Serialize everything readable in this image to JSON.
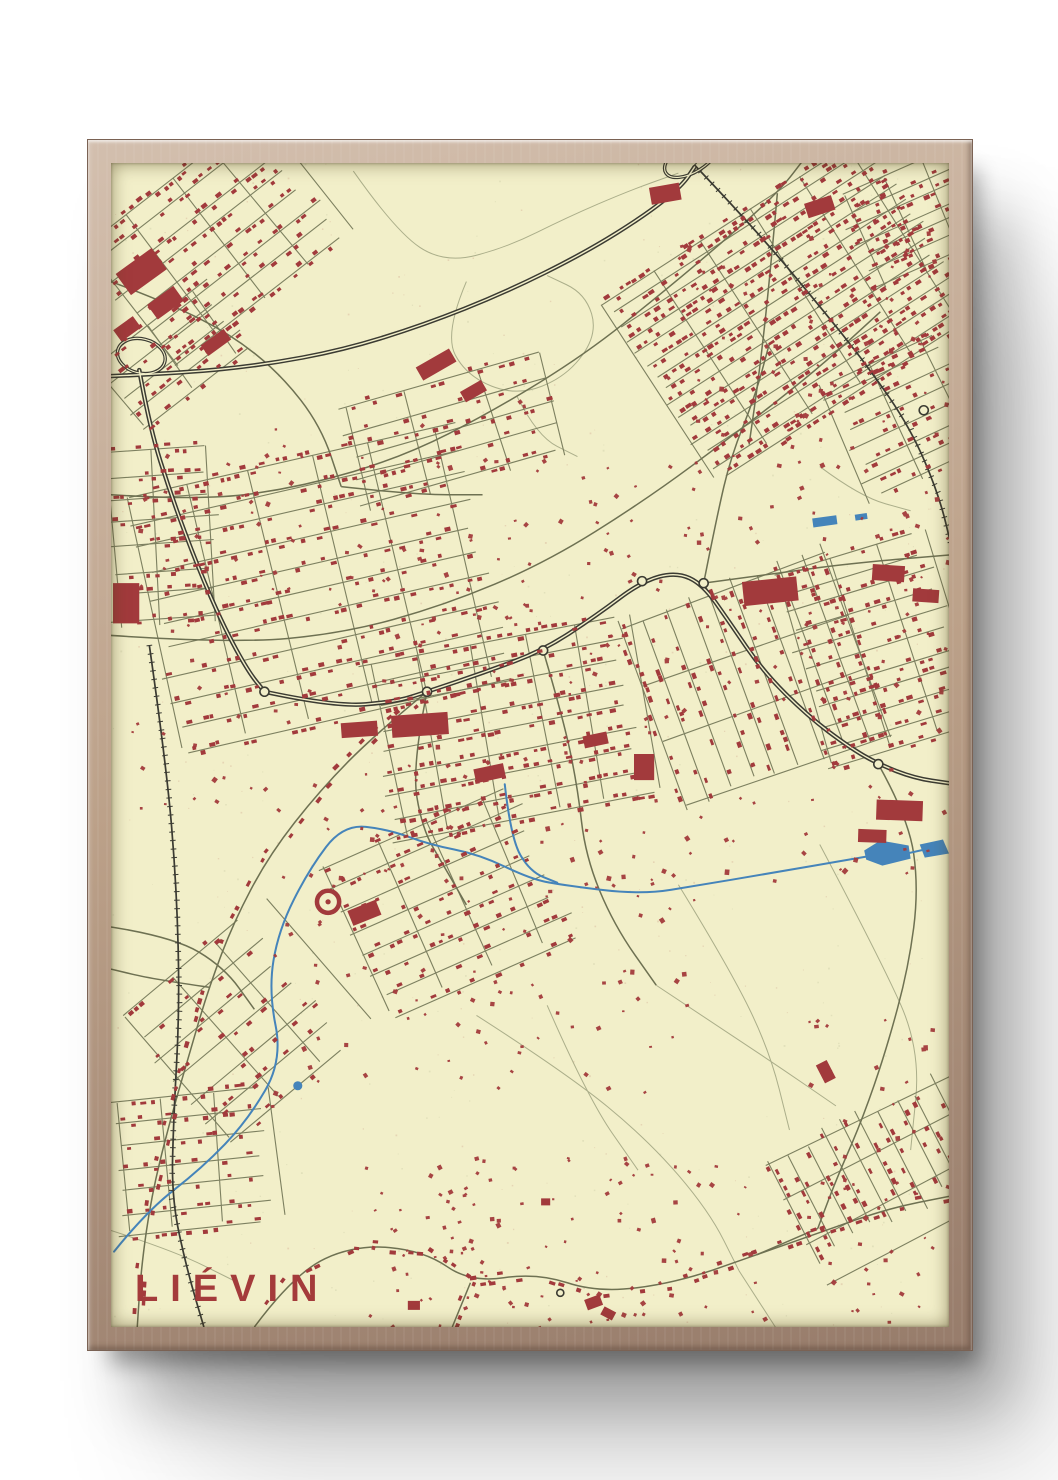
{
  "poster": {
    "title": "LIÉVIN"
  },
  "style": {
    "paper": "#f2efc9",
    "building": "#a23a3c",
    "street": "#7d8060",
    "road": "#6e7152",
    "faint": "#abae8a",
    "dark": "#3b3b32",
    "water": "#4584ba",
    "title": "#a43b3b",
    "wood_light": "#d3bfae",
    "wood_mid": "#bca189",
    "wood_dark": "#977c6b",
    "frame_edge": "#7a6254",
    "backdrop": "#ffffff"
  },
  "map": {
    "seed": 11,
    "view": [
      830,
      1158
    ],
    "speckles": 260,
    "faint": [
      [
        [
          240,
          8
        ],
        [
          282,
          68
        ],
        [
          330,
          100
        ],
        [
          392,
          84
        ],
        [
          452,
          54
        ],
        [
          512,
          28
        ],
        [
          562,
          10
        ]
      ],
      [
        [
          352,
          118
        ],
        [
          330,
          170
        ],
        [
          352,
          212
        ],
        [
          402,
          232
        ],
        [
          452,
          212
        ],
        [
          482,
          170
        ],
        [
          470,
          130
        ],
        [
          432,
          112
        ]
      ],
      [
        [
          402,
          232
        ],
        [
          422,
          272
        ],
        [
          462,
          292
        ]
      ],
      [
        [
          362,
          848
        ],
        [
          452,
          906
        ],
        [
          532,
          972
        ],
        [
          592,
          1042
        ],
        [
          622,
          1102
        ]
      ],
      [
        [
          562,
          718
        ],
        [
          612,
          800
        ],
        [
          652,
          882
        ],
        [
          672,
          962
        ]
      ],
      [
        [
          702,
          678
        ],
        [
          762,
          792
        ],
        [
          802,
          882
        ],
        [
          792,
          982
        ]
      ],
      [
        [
          432,
          838
        ],
        [
          472,
          930
        ],
        [
          522,
          1002
        ]
      ],
      [
        [
          0,
          1062
        ],
        [
          62,
          1082
        ],
        [
          122,
          1112
        ]
      ],
      [
        [
          702,
          302
        ],
        [
          742,
          332
        ],
        [
          792,
          346
        ]
      ],
      [
        [
          540,
          818
        ],
        [
          600,
          858
        ],
        [
          660,
          898
        ],
        [
          718,
          938
        ]
      ],
      [
        [
          622,
          1102
        ],
        [
          658,
          1158
        ]
      ]
    ],
    "roads": [
      {
        "p": [
          [
            0,
            330
          ],
          [
            90,
            336
          ],
          [
            190,
            322
          ],
          [
            290,
            292
          ],
          [
            380,
            246
          ],
          [
            470,
            190
          ],
          [
            545,
            130
          ],
          [
            610,
            75
          ],
          [
            662,
            28
          ],
          [
            688,
            -6
          ]
        ]
      },
      {
        "p": [
          [
            0,
            470
          ],
          [
            120,
            478
          ],
          [
            230,
            468
          ],
          [
            330,
            440
          ],
          [
            430,
            398
          ],
          [
            530,
            335
          ],
          [
            620,
            268
          ],
          [
            700,
            205
          ],
          [
            762,
            148
          ]
        ]
      },
      {
        "p": [
          [
            313,
            526
          ],
          [
            298,
            600
          ],
          [
            308,
            662
          ],
          [
            330,
            700
          ],
          [
            352,
            738
          ]
        ]
      },
      {
        "p": [
          [
            428,
            485
          ],
          [
            448,
            553
          ],
          [
            462,
            620
          ],
          [
            470,
            690
          ],
          [
            498,
            758
          ],
          [
            540,
            818
          ]
        ]
      },
      {
        "p": [
          [
            587,
            418
          ],
          [
            600,
            352
          ],
          [
            614,
            292
          ],
          [
            638,
            232
          ],
          [
            652,
            180
          ]
        ]
      },
      {
        "p": [
          [
            587,
            418
          ],
          [
            660,
            408
          ],
          [
            735,
            398
          ],
          [
            830,
            390
          ]
        ]
      },
      {
        "p": [
          [
            660,
            30
          ],
          [
            652,
            120
          ],
          [
            642,
            210
          ],
          [
            632,
            280
          ]
        ]
      },
      {
        "p": [
          [
            313,
            526
          ],
          [
            262,
            568
          ],
          [
            207,
            624
          ],
          [
            157,
            688
          ],
          [
            122,
            754
          ],
          [
            97,
            820
          ],
          [
            77,
            888
          ],
          [
            57,
            958
          ],
          [
            40,
            1028
          ],
          [
            30,
            1098
          ],
          [
            26,
            1158
          ]
        ],
        "b": 0.5
      },
      {
        "p": [
          [
            142,
            1158
          ],
          [
            182,
            1104
          ],
          [
            242,
            1076
          ],
          [
            310,
            1082
          ],
          [
            356,
            1114
          ],
          [
            422,
            1104
          ],
          [
            482,
            1124
          ],
          [
            560,
            1114
          ],
          [
            640,
            1086
          ],
          [
            702,
            1064
          ],
          [
            770,
            1040
          ],
          [
            830,
            1028
          ]
        ],
        "b": 0.55
      },
      {
        "p": [
          [
            356,
            1114
          ],
          [
            338,
            1158
          ]
        ],
        "b": 0.5
      },
      {
        "p": [
          [
            760,
            598
          ],
          [
            790,
            652
          ],
          [
            800,
            722
          ],
          [
            790,
            800
          ],
          [
            768,
            882
          ],
          [
            744,
            952
          ],
          [
            718,
            1012
          ],
          [
            700,
            1060
          ]
        ]
      },
      {
        "p": [
          [
            0,
            760
          ],
          [
            62,
            770
          ],
          [
            112,
            800
          ],
          [
            142,
            842
          ]
        ]
      },
      {
        "p": [
          [
            97,
            820
          ],
          [
            42,
            812
          ],
          [
            0,
            802
          ]
        ]
      },
      {
        "p": [
          [
            0,
            118
          ],
          [
            58,
            140
          ],
          [
            118,
            170
          ],
          [
            168,
            210
          ],
          [
            208,
            262
          ],
          [
            228,
            322
          ]
        ]
      },
      {
        "p": [
          [
            228,
            322
          ],
          [
            300,
            330
          ],
          [
            368,
            330
          ]
        ]
      },
      {
        "p": [
          [
            700,
            1060
          ],
          [
            640,
            1086
          ]
        ]
      }
    ],
    "motorways": [
      [
        [
          0,
          212
        ],
        [
          70,
          209
        ],
        [
          150,
          201
        ],
        [
          230,
          186
        ],
        [
          310,
          161
        ],
        [
          390,
          129
        ],
        [
          470,
          89
        ],
        [
          532,
          50
        ],
        [
          566,
          22
        ],
        [
          578,
          4
        ]
      ],
      [
        [
          28,
          206
        ],
        [
          38,
          262
        ],
        [
          60,
          332
        ],
        [
          86,
          402
        ],
        [
          112,
          462
        ],
        [
          136,
          506
        ],
        [
          152,
          526
        ]
      ],
      [
        [
          152,
          526
        ],
        [
          222,
          541
        ],
        [
          282,
          536
        ],
        [
          313,
          526
        ],
        [
          372,
          506
        ],
        [
          428,
          485
        ],
        [
          481,
          450
        ],
        [
          526,
          416
        ],
        [
          560,
          407
        ],
        [
          586,
          419
        ],
        [
          612,
          456
        ],
        [
          646,
          506
        ],
        [
          690,
          550
        ],
        [
          731,
          581
        ],
        [
          760,
          598
        ],
        [
          796,
          612
        ],
        [
          830,
          617
        ]
      ]
    ],
    "loops": [
      {
        "cx": 575,
        "cy": -6,
        "rx": 30,
        "ry": 15,
        "a": -32
      },
      {
        "cx": 30,
        "cy": 192,
        "rx": 24,
        "ry": 17,
        "a": 14
      }
    ],
    "railways": [
      [
        [
          578,
          2
        ],
        [
          640,
          68
        ],
        [
          700,
          140
        ],
        [
          748,
          200
        ],
        [
          792,
          264
        ],
        [
          820,
          330
        ],
        [
          833,
          384
        ]
      ],
      [
        [
          38,
          480
        ],
        [
          55,
          600
        ],
        [
          65,
          720
        ],
        [
          68,
          840
        ],
        [
          62,
          950
        ],
        [
          60,
          1030
        ],
        [
          75,
          1100
        ],
        [
          92,
          1158
        ]
      ]
    ],
    "river": [
      [
        [
          3,
          1083
        ],
        [
          35,
          1043
        ],
        [
          90,
          1000
        ],
        [
          135,
          953
        ],
        [
          170,
          893
        ],
        [
          156,
          823
        ],
        [
          166,
          763
        ],
        [
          196,
          703
        ],
        [
          230,
          658
        ],
        [
          275,
          663
        ],
        [
          315,
          678
        ],
        [
          365,
          688
        ],
        [
          415,
          712
        ],
        [
          445,
          718
        ],
        [
          525,
          728
        ],
        [
          585,
          718
        ],
        [
          645,
          708
        ],
        [
          748,
          690
        ]
      ],
      [
        [
          390,
          618
        ],
        [
          396,
          672
        ],
        [
          415,
          705
        ],
        [
          442,
          716
        ]
      ],
      [
        [
          788,
          687
        ],
        [
          806,
          683
        ]
      ]
    ],
    "ponds": [
      [
        [
          746,
          684
        ],
        [
          762,
          674
        ],
        [
          790,
          679
        ],
        [
          792,
          692
        ],
        [
          764,
          699
        ],
        [
          748,
          693
        ]
      ],
      [
        [
          801,
          678
        ],
        [
          824,
          673
        ],
        [
          830,
          687
        ],
        [
          806,
          691
        ]
      ]
    ],
    "pond_circles": [
      [
        185,
        918,
        4.5
      ]
    ],
    "water_rects": [
      {
        "x": 695,
        "y": 352,
        "w": 24,
        "h": 9,
        "a": -8
      },
      {
        "x": 737,
        "y": 349,
        "w": 12,
        "h": 6,
        "a": -8
      },
      {
        "x": 546,
        "y": 26,
        "w": 5,
        "h": 5,
        "a": 0
      }
    ],
    "roundabouts": [
      [
        313,
        526
      ],
      [
        428,
        485
      ],
      [
        526,
        416
      ],
      [
        587,
        418
      ],
      [
        760,
        598
      ],
      [
        805,
        246
      ],
      [
        152,
        526
      ],
      [
        445,
        1124,
        3.5
      ]
    ],
    "clusters": [
      {
        "x": 100,
        "y": 80,
        "w": 210,
        "h": 150,
        "a": -38,
        "gap": 21,
        "cross": 56,
        "d": 0.7
      },
      {
        "x": 62,
        "y": 190,
        "w": 130,
        "h": 75,
        "a": -38,
        "gap": 20,
        "cross": 60,
        "d": 0.6
      },
      {
        "x": 338,
        "y": 268,
        "w": 200,
        "h": 105,
        "a": -16,
        "gap": 24,
        "cross": 70,
        "d": 0.5
      },
      {
        "x": 672,
        "y": 142,
        "w": 300,
        "h": 205,
        "a": -33,
        "gap": 15,
        "cross": 58,
        "d": 0.8
      },
      {
        "x": 792,
        "y": 58,
        "w": 110,
        "h": 100,
        "a": -24,
        "gap": 16,
        "cross": 46,
        "d": 0.65
      },
      {
        "x": 205,
        "y": 420,
        "w": 330,
        "h": 255,
        "a": -13,
        "gap": 26,
        "cross": 62,
        "d": 0.6
      },
      {
        "x": 48,
        "y": 372,
        "w": 105,
        "h": 175,
        "a": -4,
        "gap": 24,
        "cross": 55,
        "d": 0.55
      },
      {
        "x": 392,
        "y": 562,
        "w": 250,
        "h": 175,
        "a": -11,
        "gap": 22,
        "cross": 52,
        "d": 0.75
      },
      {
        "x": 638,
        "y": 512,
        "w": 195,
        "h": 215,
        "a": 70,
        "gap": 24,
        "cross": 66,
        "d": 0.55
      },
      {
        "x": 756,
        "y": 482,
        "w": 148,
        "h": 195,
        "a": -17,
        "gap": 20,
        "cross": 54,
        "d": 0.6
      },
      {
        "x": 786,
        "y": 252,
        "w": 118,
        "h": 128,
        "a": -25,
        "gap": 18,
        "cross": 50,
        "d": 0.55
      },
      {
        "x": 332,
        "y": 732,
        "w": 200,
        "h": 158,
        "a": -24,
        "gap": 24,
        "cross": 58,
        "d": 0.55
      },
      {
        "x": 122,
        "y": 862,
        "w": 150,
        "h": 158,
        "a": -40,
        "gap": 27,
        "cross": 60,
        "d": 0.45
      },
      {
        "x": 78,
        "y": 992,
        "w": 140,
        "h": 128,
        "a": -6,
        "gap": 22,
        "cross": 50,
        "d": 0.5
      },
      {
        "x": 772,
        "y": 992,
        "w": 105,
        "h": 225,
        "a": 63,
        "gap": 20,
        "cross": 42,
        "d": 0.65
      }
    ],
    "scatter": [
      {
        "x": 480,
        "y": 300,
        "w": 350,
        "h": 420,
        "n": 130
      },
      {
        "x": 20,
        "y": 230,
        "w": 460,
        "h": 420,
        "n": 150
      },
      {
        "x": 160,
        "y": 650,
        "w": 420,
        "h": 290,
        "n": 110
      },
      {
        "x": 550,
        "y": 60,
        "w": 280,
        "h": 240,
        "n": 70
      },
      {
        "x": 250,
        "y": 990,
        "w": 400,
        "h": 170,
        "n": 120
      },
      {
        "x": 690,
        "y": 850,
        "w": 140,
        "h": 310,
        "n": 50
      }
    ],
    "blocks": [
      [
        8,
        95,
        44,
        26,
        -36
      ],
      [
        38,
        130,
        32,
        18,
        -36
      ],
      [
        4,
        158,
        24,
        14,
        -36
      ],
      [
        90,
        172,
        28,
        13,
        -36
      ],
      [
        534,
        22,
        30,
        17,
        -10
      ],
      [
        688,
        36,
        28,
        15,
        -18
      ],
      [
        303,
        193,
        38,
        15,
        -30
      ],
      [
        347,
        221,
        24,
        12,
        -30
      ],
      [
        278,
        548,
        56,
        22,
        -4
      ],
      [
        228,
        556,
        36,
        15,
        -4
      ],
      [
        2,
        418,
        26,
        40,
        0
      ],
      [
        626,
        414,
        54,
        24,
        -6
      ],
      [
        754,
        400,
        32,
        16,
        4
      ],
      [
        794,
        424,
        26,
        13,
        4
      ],
      [
        758,
        634,
        46,
        20,
        2
      ],
      [
        740,
        663,
        28,
        13,
        2
      ],
      [
        236,
        738,
        30,
        16,
        -22
      ],
      [
        360,
        600,
        30,
        14,
        -12
      ],
      [
        468,
        568,
        24,
        12,
        -12
      ],
      [
        518,
        588,
        20,
        26,
        0
      ],
      [
        698,
        898,
        20,
        12,
        63
      ],
      [
        470,
        1128,
        16,
        11,
        -20
      ],
      [
        486,
        1140,
        13,
        9,
        28
      ],
      [
        294,
        1132,
        12,
        9,
        0
      ],
      [
        426,
        1030,
        9,
        7,
        0
      ]
    ],
    "stadium": {
      "x": 215,
      "y": 735,
      "r": 11
    }
  }
}
